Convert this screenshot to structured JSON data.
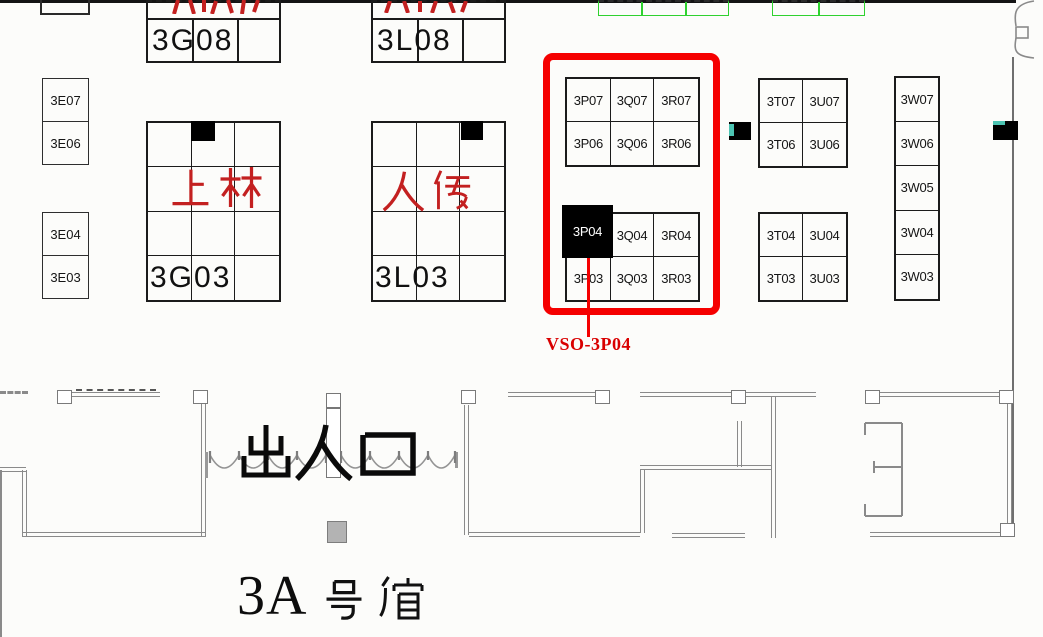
{
  "hall": {
    "name_prefix": "3A",
    "name_suffix": "号馆",
    "name_full": "3A号馆",
    "entrance_label": "出入口"
  },
  "callout": {
    "label": "VSO-3P04",
    "target_booth": "3P04"
  },
  "booths": {
    "e_column": [
      "3E07",
      "3E06",
      "3E04",
      "3E03"
    ],
    "g_block": {
      "top_label": "3G08",
      "main_label": "3G03",
      "red_text": "上林"
    },
    "l_block": {
      "top_label": "3L08",
      "main_label": "3L03",
      "red_text": "人传"
    },
    "pqr": {
      "rows": [
        [
          "3P07",
          "3Q07",
          "3R07"
        ],
        [
          "3P06",
          "3Q06",
          "3R06"
        ],
        [
          "3P04",
          "3Q04",
          "3R04"
        ],
        [
          "3P03",
          "3Q03",
          "3R03"
        ]
      ]
    },
    "tu": {
      "rows": [
        [
          "3T07",
          "3U07"
        ],
        [
          "3T06",
          "3U06"
        ],
        [
          "3T04",
          "3U04"
        ],
        [
          "3T03",
          "3U03"
        ]
      ]
    },
    "w_column": [
      "3W07",
      "3W06",
      "3W05",
      "3W04",
      "3W03"
    ]
  },
  "colors": {
    "highlight_red": "#f50000",
    "callout_text_red": "#d90000",
    "red_cjk_text": "#c32020",
    "selected_booth_fill": "#000000",
    "selected_booth_text": "#ffffff",
    "teal_accent": "#4cc4b2",
    "green_outline": "#2fd12f",
    "wall_gray": "#8a8a8a",
    "booth_line": "#1b1b1b"
  }
}
